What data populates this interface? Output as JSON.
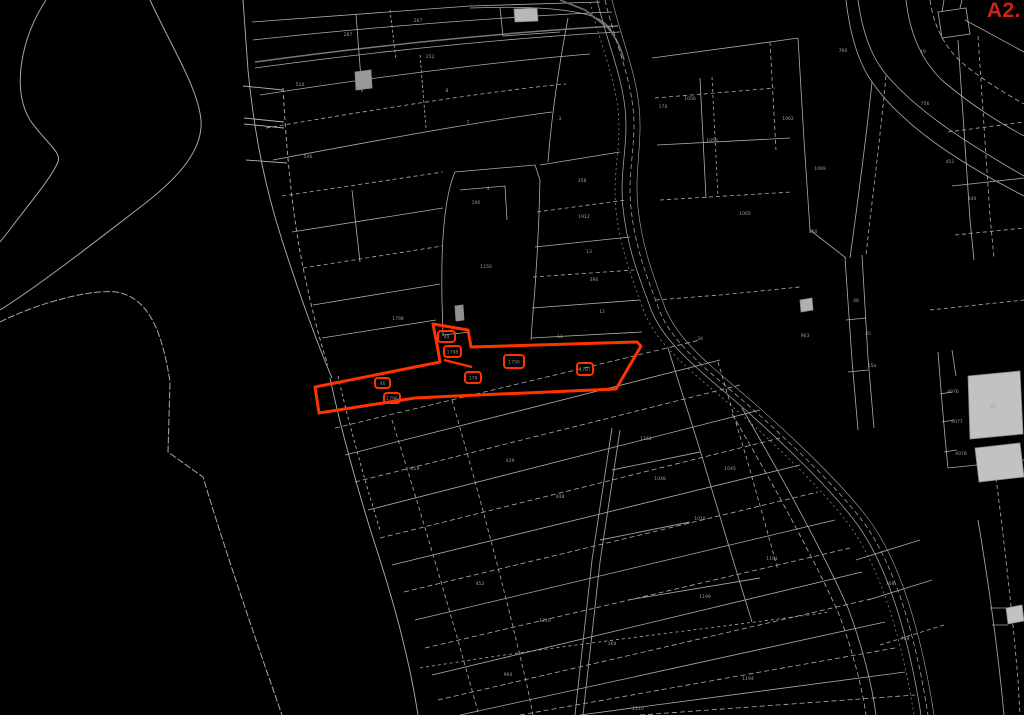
{
  "map": {
    "sheet_label": "A2.",
    "colors": {
      "background": "#000000",
      "parcel_line": "#b0b0b0",
      "road_line": "#787878",
      "highlight_red": "#ff3300",
      "sheet_label_red": "#cf2218",
      "building_fill": "#c2c2c2",
      "building_dark_fill": "#909090"
    },
    "highlighted_parcel": {
      "boxes": [
        {
          "x": 438,
          "y": 331,
          "w": 17,
          "h": 11,
          "t": "49"
        },
        {
          "x": 444,
          "y": 346,
          "w": 17,
          "h": 11,
          "t": "1798"
        },
        {
          "x": 504,
          "y": 355,
          "w": 20,
          "h": 13,
          "t": "1790"
        },
        {
          "x": 577,
          "y": 363,
          "w": 16,
          "h": 12,
          "t": "1787"
        },
        {
          "x": 465,
          "y": 372,
          "w": 16,
          "h": 11,
          "t": "178"
        },
        {
          "x": 375,
          "y": 378,
          "w": 15,
          "h": 10,
          "t": "46"
        },
        {
          "x": 384,
          "y": 393,
          "w": 16,
          "h": 10,
          "t": "1796"
        }
      ]
    },
    "parcel_labels": [
      {
        "x": 300,
        "y": 86,
        "t": "510"
      },
      {
        "x": 308,
        "y": 158,
        "t": "546"
      },
      {
        "x": 348,
        "y": 36,
        "t": "287"
      },
      {
        "x": 418,
        "y": 22,
        "t": "267"
      },
      {
        "x": 430,
        "y": 58,
        "t": "152"
      },
      {
        "x": 447,
        "y": 92,
        "t": "8"
      },
      {
        "x": 468,
        "y": 124,
        "t": "7"
      },
      {
        "x": 488,
        "y": 190,
        "t": "4"
      },
      {
        "x": 486,
        "y": 268,
        "t": "1150"
      },
      {
        "x": 476,
        "y": 204,
        "t": "190"
      },
      {
        "x": 560,
        "y": 120,
        "t": "3"
      },
      {
        "x": 582,
        "y": 182,
        "t": "358"
      },
      {
        "x": 584,
        "y": 218,
        "t": "1912"
      },
      {
        "x": 589,
        "y": 253,
        "t": "13"
      },
      {
        "x": 594,
        "y": 281,
        "t": "390"
      },
      {
        "x": 602,
        "y": 313,
        "t": "12"
      },
      {
        "x": 560,
        "y": 338,
        "t": "11"
      },
      {
        "x": 663,
        "y": 108,
        "t": "176"
      },
      {
        "x": 690,
        "y": 100,
        "t": "1056"
      },
      {
        "x": 712,
        "y": 142,
        "t": "1059"
      },
      {
        "x": 788,
        "y": 120,
        "t": "1062"
      },
      {
        "x": 745,
        "y": 215,
        "t": "1065"
      },
      {
        "x": 820,
        "y": 170,
        "t": "1069"
      },
      {
        "x": 843,
        "y": 52,
        "t": "760"
      },
      {
        "x": 923,
        "y": 53,
        "t": "19"
      },
      {
        "x": 925,
        "y": 105,
        "t": "756"
      },
      {
        "x": 950,
        "y": 163,
        "t": "451"
      },
      {
        "x": 972,
        "y": 200,
        "t": "340"
      },
      {
        "x": 813,
        "y": 233,
        "t": "460"
      },
      {
        "x": 856,
        "y": 302,
        "t": "48"
      },
      {
        "x": 868,
        "y": 335,
        "t": "45"
      },
      {
        "x": 872,
        "y": 367,
        "t": "15a"
      },
      {
        "x": 953,
        "y": 393,
        "t": "4076"
      },
      {
        "x": 957,
        "y": 423,
        "t": "4077"
      },
      {
        "x": 961,
        "y": 455,
        "t": "4078"
      },
      {
        "x": 993,
        "y": 408,
        "t": "93"
      },
      {
        "x": 805,
        "y": 337,
        "t": "963"
      },
      {
        "x": 700,
        "y": 340,
        "t": "34"
      },
      {
        "x": 646,
        "y": 440,
        "t": "1164"
      },
      {
        "x": 398,
        "y": 320,
        "t": "1798"
      },
      {
        "x": 415,
        "y": 470,
        "t": "419"
      },
      {
        "x": 510,
        "y": 462,
        "t": "439"
      },
      {
        "x": 560,
        "y": 498,
        "t": "448"
      },
      {
        "x": 480,
        "y": 585,
        "t": "452"
      },
      {
        "x": 545,
        "y": 622,
        "t": "1216"
      },
      {
        "x": 508,
        "y": 676,
        "t": "964"
      },
      {
        "x": 612,
        "y": 645,
        "t": "169"
      },
      {
        "x": 705,
        "y": 598,
        "t": "1199"
      },
      {
        "x": 748,
        "y": 680,
        "t": "1194"
      },
      {
        "x": 638,
        "y": 710,
        "t": "1210"
      },
      {
        "x": 772,
        "y": 560,
        "t": "1191"
      },
      {
        "x": 700,
        "y": 520,
        "t": "1019"
      },
      {
        "x": 660,
        "y": 480,
        "t": "1048"
      },
      {
        "x": 730,
        "y": 470,
        "t": "1045"
      },
      {
        "x": 890,
        "y": 585,
        "t": "768"
      },
      {
        "x": 905,
        "y": 640,
        "t": "769"
      }
    ]
  }
}
